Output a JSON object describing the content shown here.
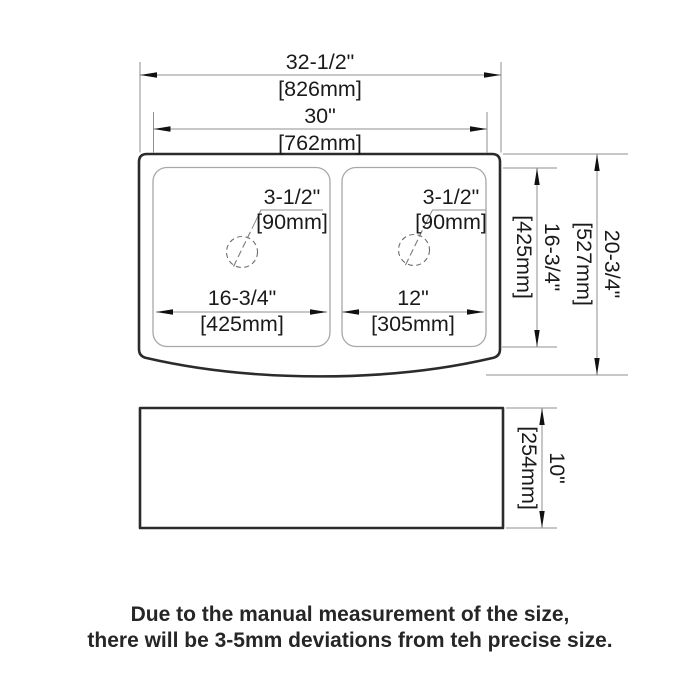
{
  "page": {
    "background": "#ffffff"
  },
  "colors": {
    "outline_dark": "#2b2b2b",
    "dimension_gray": "#8f8f8f",
    "bowl_gray": "#a8a8a8",
    "text": "#1a1a1a"
  },
  "drawing": {
    "top_view": {
      "overall_width": {
        "in": "32-1/2\"",
        "mm": "[826mm]"
      },
      "inner_width": {
        "in": "30\"",
        "mm": "[762mm]"
      },
      "left_drain": {
        "in": "3-1/2\"",
        "mm": "[90mm]"
      },
      "right_drain": {
        "in": "3-1/2\"",
        "mm": "[90mm]"
      },
      "left_bowl_width": {
        "in": "16-3/4\"",
        "mm": "[425mm]"
      },
      "right_bowl_width": {
        "in": "12\"",
        "mm": "[305mm]"
      },
      "bowl_depth": {
        "in": "16-3/4\"",
        "mm": "[425mm]"
      },
      "overall_depth": {
        "in": "20-3/4\"",
        "mm": "[527mm]"
      }
    },
    "side_view": {
      "height": {
        "in": "10\"",
        "mm": "[254mm]"
      }
    }
  },
  "note": {
    "line1": "Due to the manual measurement of the size,",
    "line2": "there will be 3-5mm deviations from teh precise size."
  }
}
